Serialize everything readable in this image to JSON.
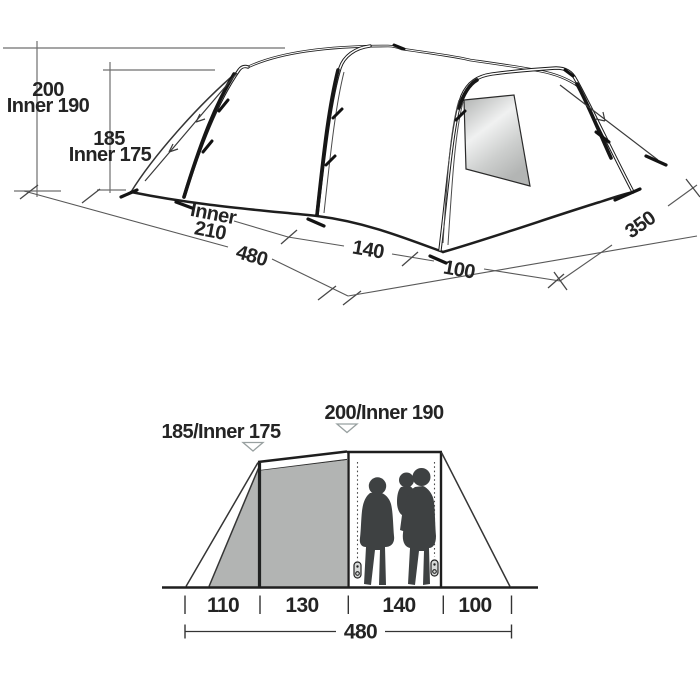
{
  "perspective": {
    "height_200": "200",
    "inner_190": "Inner 190",
    "height_185": "185",
    "inner_175": "Inner 175",
    "inner_word": "Inner",
    "inner_210": "210",
    "len_480": "480",
    "len_140": "140",
    "len_100": "100",
    "width_350": "350"
  },
  "elevation": {
    "label_left": "185/Inner 175",
    "label_center": "200/Inner 190",
    "sections": [
      "110",
      "130",
      "140",
      "100"
    ],
    "total": "480"
  },
  "icons": {
    "height_marker": "triangle-down"
  },
  "colors": {
    "line": "#1e1e1e",
    "dimension_line": "#585858",
    "inner_tent_gray": "#b2b4b3",
    "silhouette": "#3e4142",
    "window_light": "#f0f1f1",
    "background": "#ffffff"
  }
}
